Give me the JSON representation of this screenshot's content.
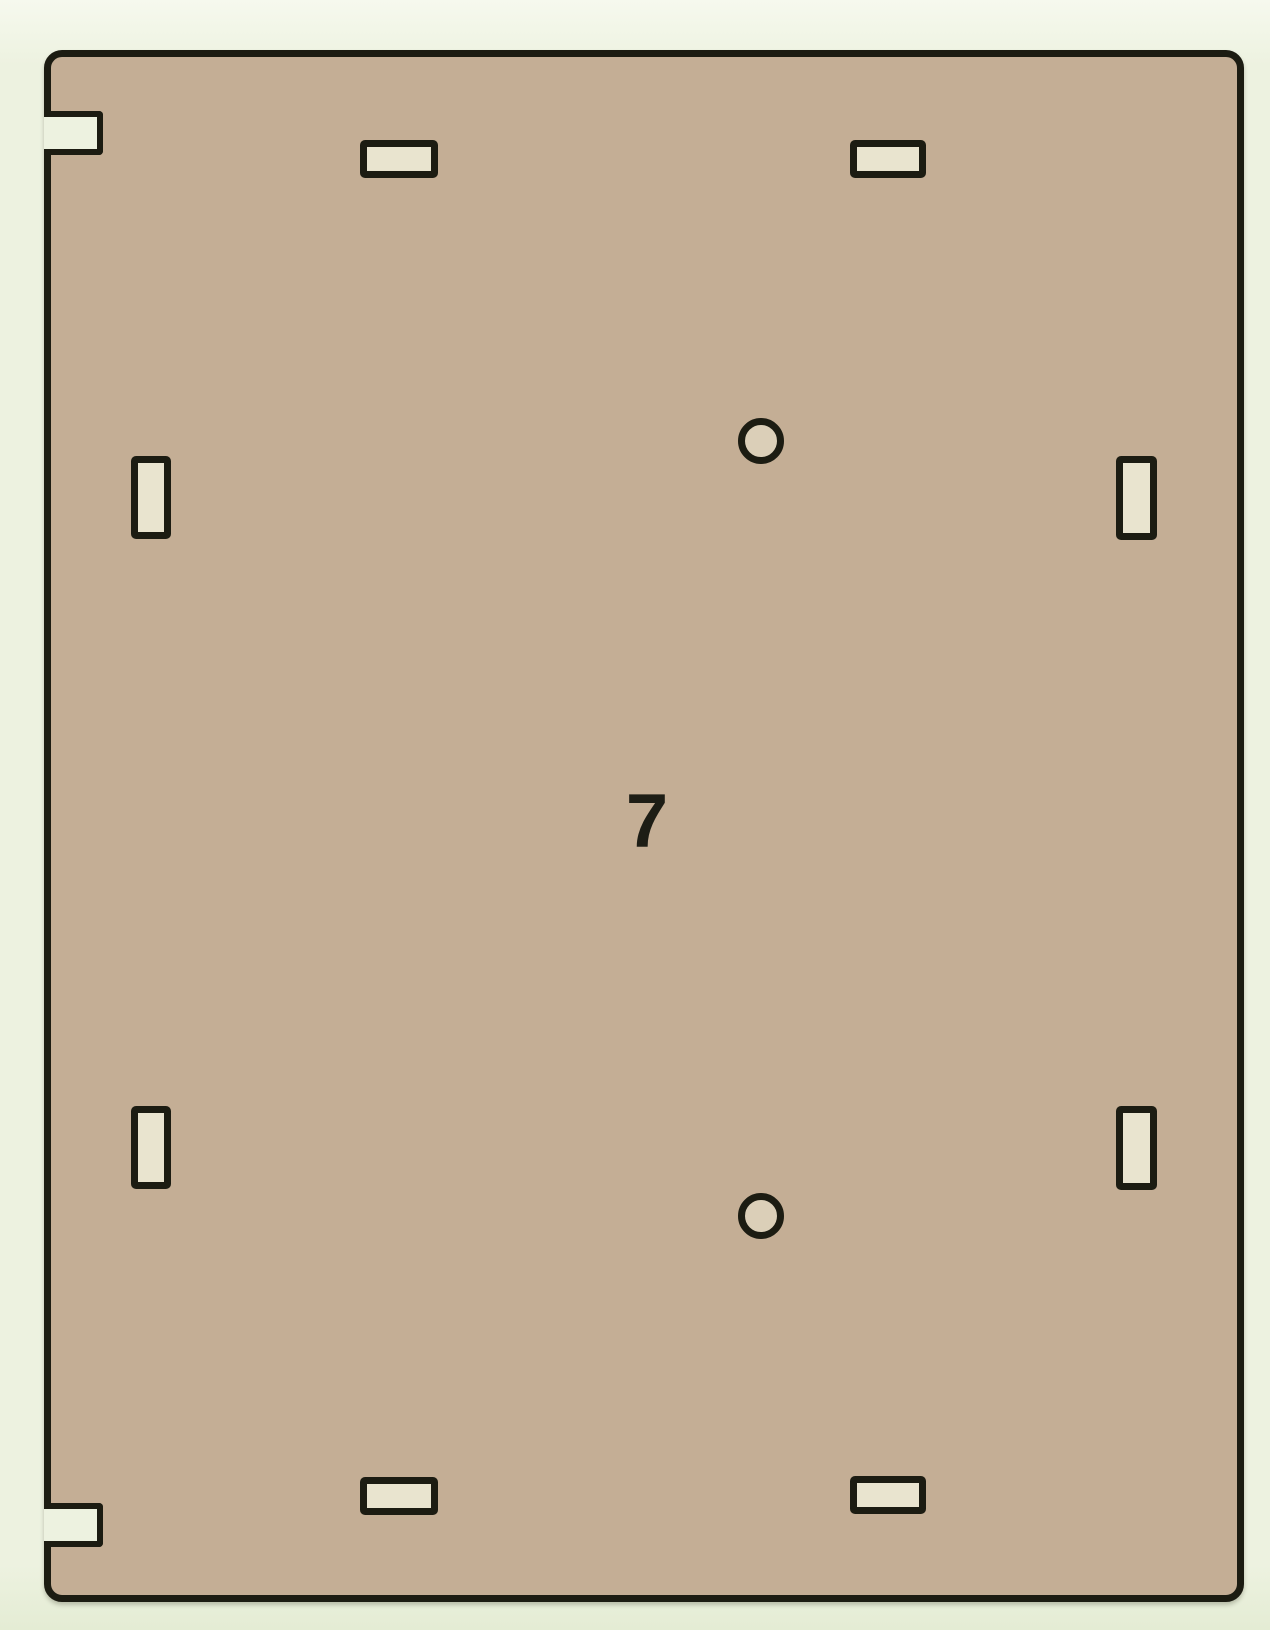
{
  "diagram": {
    "part_label": "7",
    "description": "Laser-cut rectangular panel piece (part 7) with rounded corners, two open notches on the left edge, four horizontal tab slots, four vertical tab slots and two round screw holes",
    "colors": {
      "background": "#edf2e0",
      "panel_fill": "#c4ae95",
      "outline": "#1c1c12",
      "slot_fill": "#e9e4cf",
      "hole_fill": "#dbcfb8"
    },
    "panel": {
      "x": 44,
      "y": 50,
      "width": 1200,
      "height": 1552,
      "corner_radius": 18,
      "stroke_width": 7
    },
    "label_position": {
      "x": 647,
      "y": 825
    },
    "edge_notches": [
      {
        "id": "notch-left-top",
        "edge": "left",
        "x": 44,
        "y": 111,
        "w": 59,
        "h": 44
      },
      {
        "id": "notch-left-bottom",
        "edge": "left",
        "x": 44,
        "y": 1503,
        "w": 59,
        "h": 44
      }
    ],
    "slots": [
      {
        "id": "slot-top-left",
        "orientation": "horizontal",
        "x": 360,
        "y": 140,
        "w": 78,
        "h": 38
      },
      {
        "id": "slot-top-right",
        "orientation": "horizontal",
        "x": 850,
        "y": 140,
        "w": 76,
        "h": 38
      },
      {
        "id": "slot-mid-upper-left",
        "orientation": "vertical",
        "x": 131,
        "y": 456,
        "w": 40,
        "h": 83
      },
      {
        "id": "slot-mid-upper-right",
        "orientation": "vertical",
        "x": 1116,
        "y": 456,
        "w": 41,
        "h": 84
      },
      {
        "id": "slot-mid-lower-left",
        "orientation": "vertical",
        "x": 131,
        "y": 1106,
        "w": 40,
        "h": 83
      },
      {
        "id": "slot-mid-lower-right",
        "orientation": "vertical",
        "x": 1116,
        "y": 1106,
        "w": 41,
        "h": 84
      },
      {
        "id": "slot-bottom-left",
        "orientation": "horizontal",
        "x": 360,
        "y": 1477,
        "w": 78,
        "h": 38
      },
      {
        "id": "slot-bottom-right",
        "orientation": "horizontal",
        "x": 850,
        "y": 1476,
        "w": 76,
        "h": 38
      }
    ],
    "holes": [
      {
        "id": "hole-upper",
        "cx": 761,
        "cy": 441,
        "r": 23
      },
      {
        "id": "hole-lower",
        "cx": 761,
        "cy": 1216,
        "r": 23
      }
    ]
  }
}
